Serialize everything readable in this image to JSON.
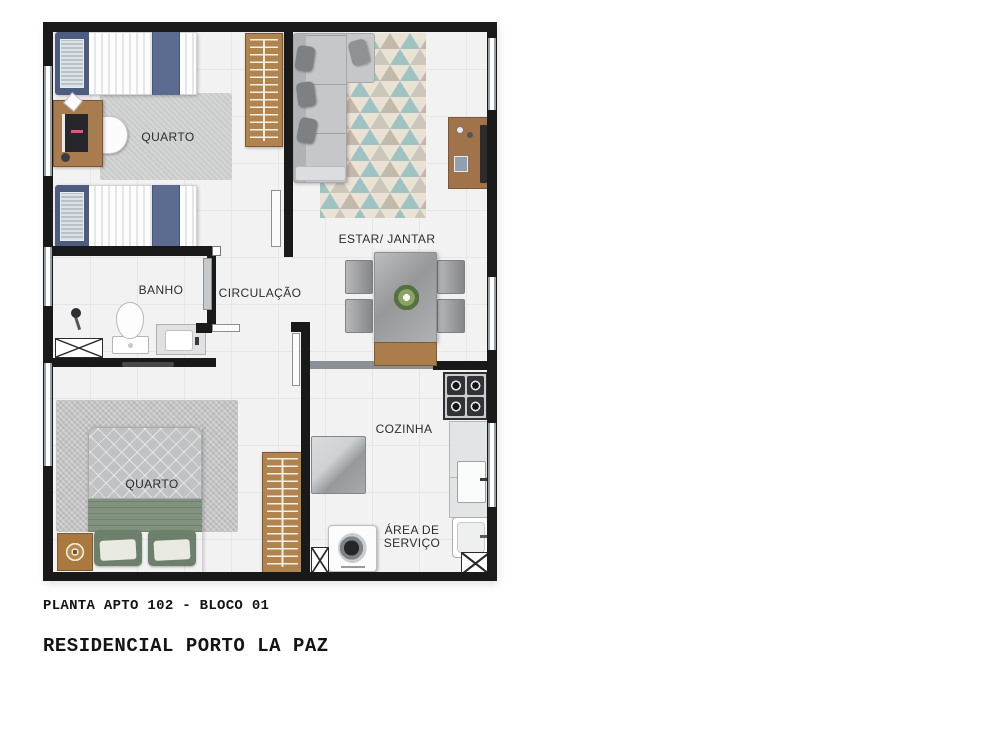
{
  "plan": {
    "rooms": [
      {
        "name": "bedroom-1",
        "label": "QUARTO"
      },
      {
        "name": "living-dining",
        "label": "ESTAR/ JANTAR"
      },
      {
        "name": "bathroom",
        "label": "BANHO"
      },
      {
        "name": "hallway",
        "label": "CIRCULAÇÃO"
      },
      {
        "name": "bedroom-2",
        "label": "QUARTO"
      },
      {
        "name": "kitchen",
        "label": "COZINHA"
      },
      {
        "name": "service-area",
        "label": "ÁREA DE SERVIÇO"
      }
    ],
    "furniture": [
      "single-bed",
      "single-bed",
      "desk",
      "desk-chair",
      "wardrobe",
      "rug",
      "sofa",
      "triangle-rug",
      "tv-stand",
      "dining-table",
      "dining-chair",
      "dining-chair",
      "dining-chair",
      "dining-chair",
      "bench",
      "toilet",
      "vanity-sink",
      "shower",
      "shower-box",
      "double-bed",
      "round-side-table",
      "wardrobe",
      "stove",
      "counter-sink",
      "laundry-tank",
      "washing-machine",
      "fridge"
    ],
    "colors": {
      "wall": "#191919",
      "floor": "#f2f2f3",
      "window": "#98a0a6",
      "wood": "#ab7c4c",
      "bed_blue": "#4d5d80",
      "bed_green": "#81937e",
      "sofa_gray": "#c5c7c9",
      "rug_cream": "#eae2d4",
      "rug_teal": "#9ec3c2",
      "rug_tan": "#c3b9ab"
    }
  },
  "captions": {
    "plan_title": "PLANTA APTO 102 - BLOCO 01",
    "project_title": "RESIDENCIAL PORTO LA PAZ"
  }
}
